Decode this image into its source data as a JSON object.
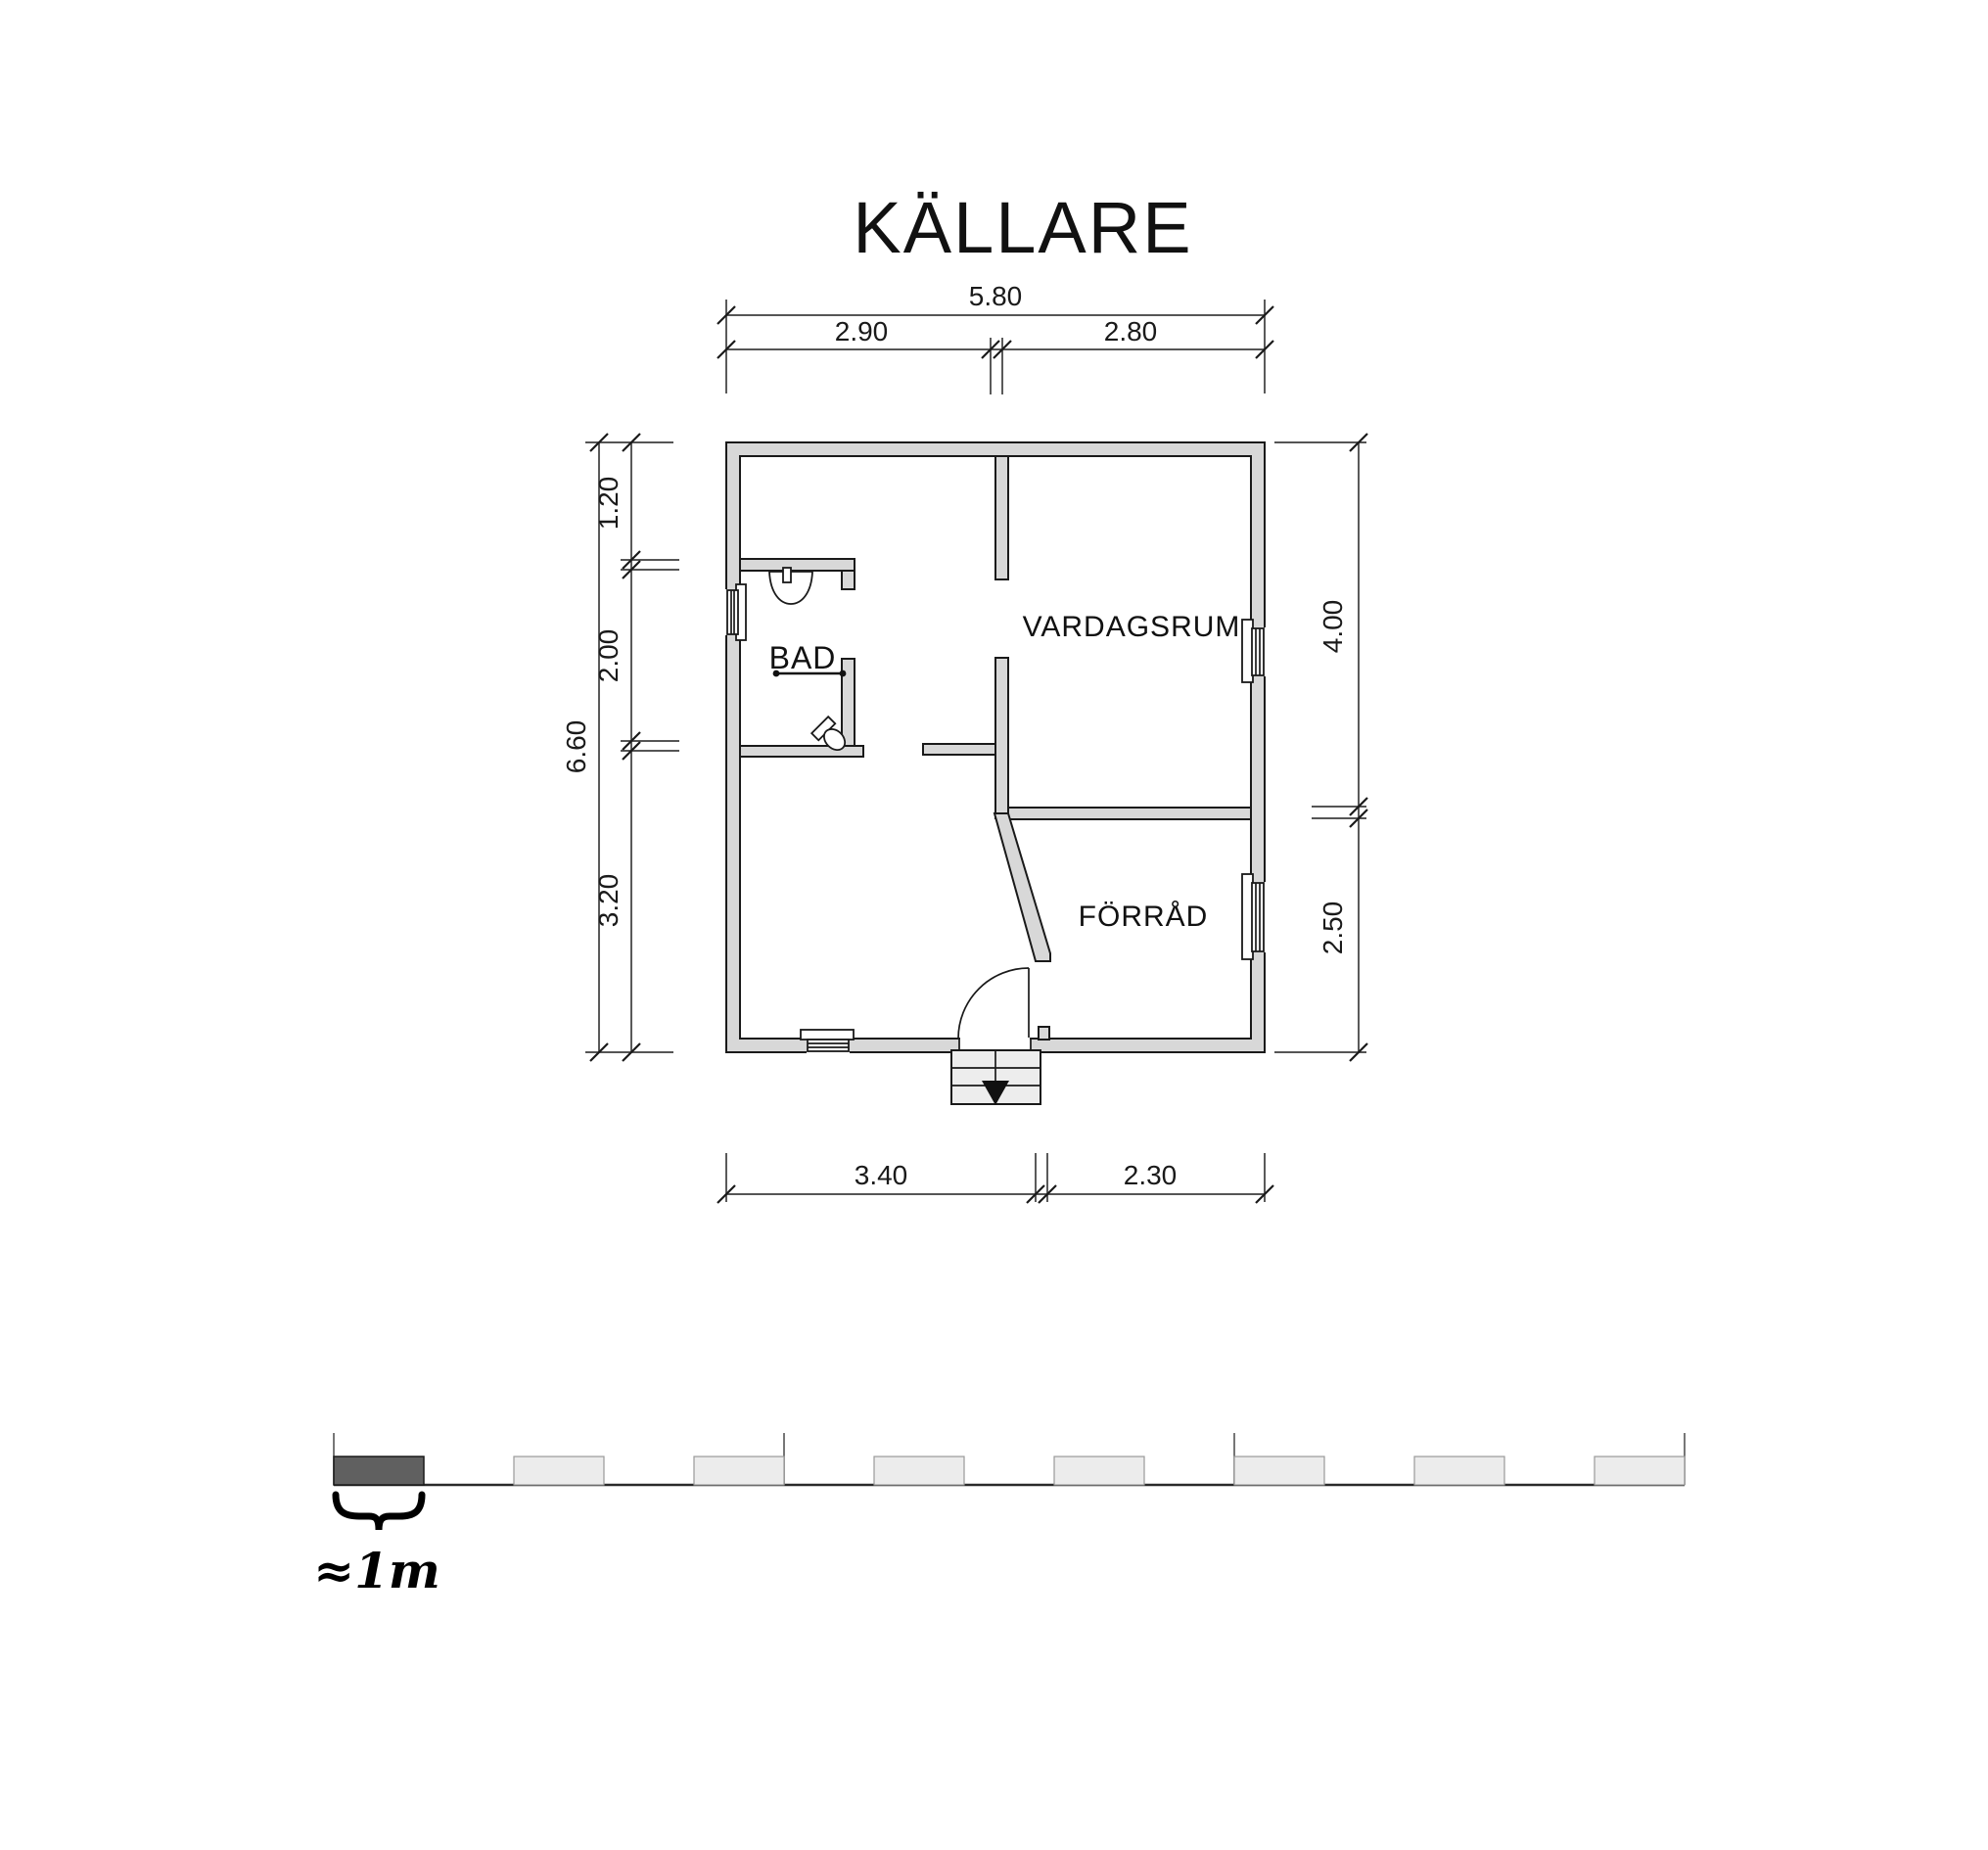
{
  "title": "KÄLLARE",
  "rooms": {
    "bathroom": "BAD",
    "living_room": "VARDAGSRUM",
    "storage": "FÖRRÅD"
  },
  "dimensions": {
    "top": {
      "total": "5.80",
      "segments": [
        "2.90",
        "2.80"
      ]
    },
    "left": {
      "total": "6.60",
      "segments": [
        "1.20",
        "2.00",
        "3.20"
      ]
    },
    "right": {
      "segments": [
        "4.00",
        "2.50"
      ]
    },
    "bottom": {
      "segments": [
        "3.40",
        "2.30"
      ]
    }
  },
  "scale_bar": {
    "label": "≈1m",
    "meters_shown": 15
  },
  "colors": {
    "wall_fill": "#d8d8d8",
    "outline": "#1a1a1a",
    "dimension_line": "#3d3d3d",
    "scale_dark_segment": "#606060",
    "scale_light_segment": "#ececec",
    "stair_fill": "#ededed"
  }
}
